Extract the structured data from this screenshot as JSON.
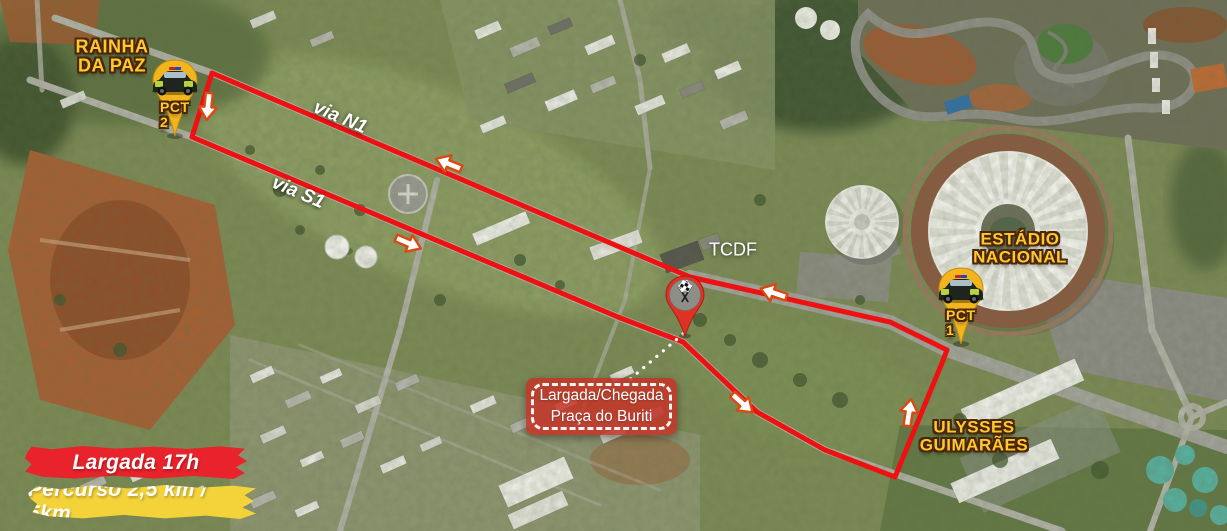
{
  "map_labels": {
    "rainha_line1": "RAINHA",
    "rainha_line2": "DA PAZ",
    "via_n1": "via N1",
    "via_s1": "via S1",
    "tcdf": "TCDF",
    "estadio_line1": "ESTÁDIO",
    "estadio_line2": "NACIONAL",
    "ulysses_line1": "ULYSSES",
    "ulysses_line2": "GUIMARÃES"
  },
  "markers": {
    "pct1": "PCT 1",
    "pct2": "PCT 2",
    "pct_icon": "police-car-icon",
    "start_finish_icon": "checkered-flags-icon",
    "direction_icon": "direction-arrow-icon"
  },
  "callout": {
    "line1": "Largada/Chegada",
    "line2": "Praça do Buriti"
  },
  "banners": {
    "start_time": "Largada 17h",
    "course": "Percurso 2,5 km / 5km"
  },
  "colors": {
    "route_red": "#ee1111",
    "label_yellow": "#ffc82e",
    "label_outline": "#4a2708",
    "pin_yellow": "#f2b51d",
    "start_pin_red": "#e03125",
    "banner_red": "#e8232b",
    "banner_yellow": "#f4d23a",
    "callout_red": "#c63428",
    "arrow_outline": "#d84a12"
  }
}
